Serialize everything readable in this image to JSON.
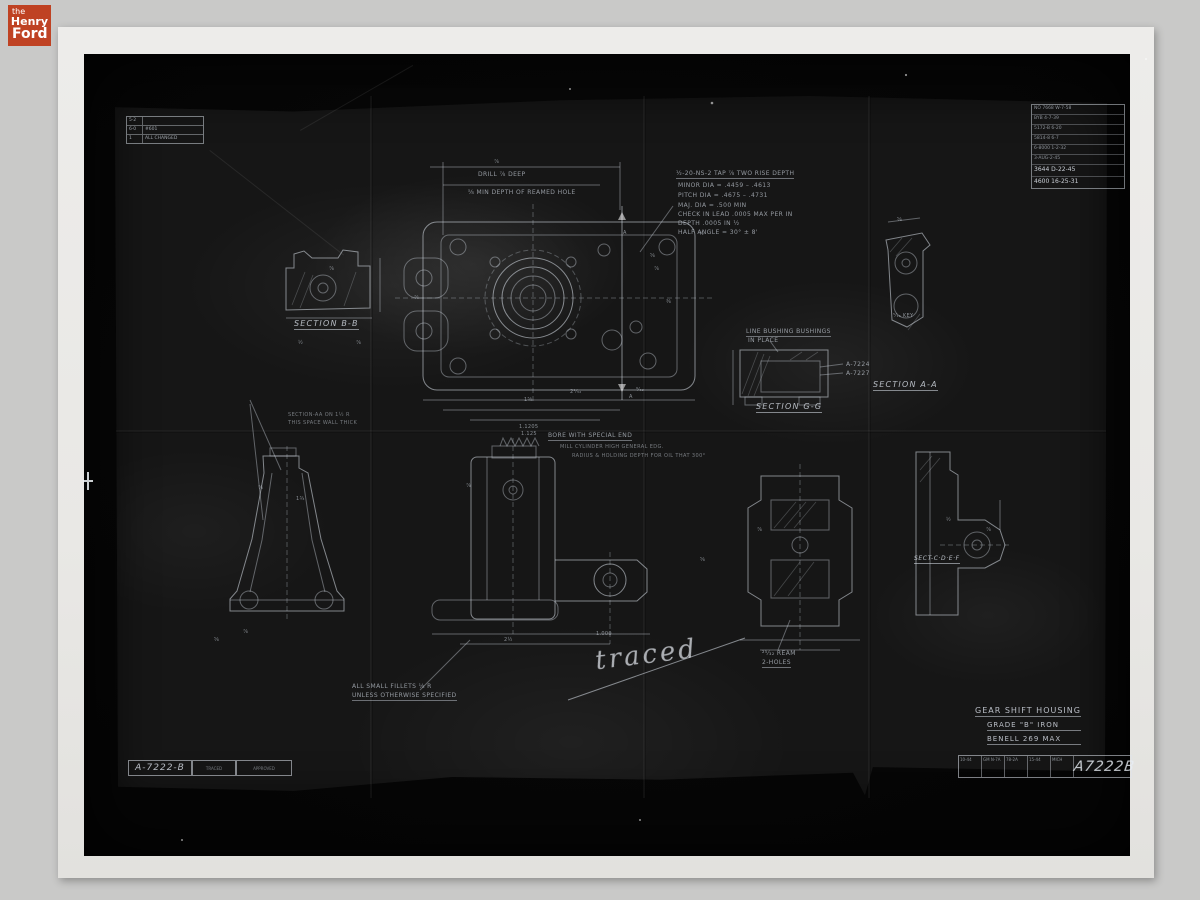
{
  "logo": {
    "the": "the",
    "henry": "Henry",
    "ford": "Ford"
  },
  "rev_table_tl": {
    "rows": [
      [
        "5·2",
        ""
      ],
      [
        "6·0",
        "#601"
      ],
      [
        "1",
        "ALL CHANGED"
      ]
    ]
  },
  "rev_table_tr": {
    "rows": [
      "NO 7668 W-7-58",
      "BYB 4-7-39",
      "5172-B 6-20",
      "5814-8 6-7",
      "6-8000 1-2-32",
      "3-AUG-2-45",
      "3644 D-22-45",
      "4600 16-25-31"
    ]
  },
  "notes": {
    "drill": "DRILL ⅞ DEEP",
    "ream": "⅝ MIN DEPTH OF REAMED HOLE",
    "thread1": "½-20-NS-2 TAP ⅞ TWO RISE DEPTH",
    "thread2": "MINOR DIA = .4459 – .4613",
    "thread3": "PITCH DIA = .4675 – .4731",
    "thread4": "MAJ. DIA = .500 MIN",
    "thread5": "CHECK IN LEAD .0005 MAX PER IN",
    "thread6": "DEPTH .0005 IN ½",
    "thread7": "HALF ANGLE = 30° ± 8'",
    "bushing1": "LINE BUSHING BUSHINGS",
    "bushing2": "IN PLACE",
    "a7224": "A-7224",
    "a7227": "A-7227",
    "bore": "BORE WITH SPECIAL END",
    "mill": "MILL CYLINDER HIGH GENERAL EDG.",
    "oil": "RADIUS & HOLDING DEPTH FOR OIL THAT 300°",
    "left1": "SECTION-AA ON 1½ R",
    "left2": "THIS SPACE WALL THICK",
    "fillets1": "ALL SMALL FILLETS ⅛ R",
    "fillets2": "UNLESS OTHERWISE SPECIFIED",
    "ream2a": "²⁵⁄₃₂ REAM",
    "ream2b": "2-HOLES",
    "traced": "traced"
  },
  "sections": {
    "bb": "SECTION B-B",
    "gg": "SECTION G-G",
    "aa": "SECTION A-A",
    "cdef": "SECT-C·D·E·F"
  },
  "title_block": {
    "title": "GEAR SHIFT HOUSING",
    "grade": "GRADE \"B\" IRON",
    "brinell": "BENELL 269 MAX",
    "number": "A7222B",
    "cells": [
      "10-44",
      "GM N-7A",
      "78-2A",
      "15-44",
      "MICH"
    ]
  },
  "corner_block_bl": {
    "number": "A-7222-B",
    "cells": [
      "TRACED",
      "APPROVED"
    ]
  },
  "dims": [
    {
      "t": "⅞",
      "x": 494,
      "y": 159
    },
    {
      "t": "⅝",
      "x": 650,
      "y": 253
    },
    {
      "t": "⅞",
      "x": 654,
      "y": 266
    },
    {
      "t": "⅜",
      "x": 666,
      "y": 299
    },
    {
      "t": "½",
      "x": 699,
      "y": 231
    },
    {
      "t": "A",
      "x": 623,
      "y": 230
    },
    {
      "t": "A",
      "x": 629,
      "y": 394
    },
    {
      "t": "⅞",
      "x": 414,
      "y": 295
    },
    {
      "t": "2¹⁄₃₂",
      "x": 570,
      "y": 389
    },
    {
      "t": "1⅝",
      "x": 524,
      "y": 397
    },
    {
      "t": "⁹⁄₃₂",
      "x": 636,
      "y": 387
    },
    {
      "t": "⅝",
      "x": 897,
      "y": 217
    },
    {
      "t": "⅞",
      "x": 329,
      "y": 266
    },
    {
      "t": "½",
      "x": 298,
      "y": 340
    },
    {
      "t": "⅞",
      "x": 356,
      "y": 340
    },
    {
      "t": "1.1205",
      "x": 519,
      "y": 424
    },
    {
      "t": "1.125",
      "x": 521,
      "y": 431
    },
    {
      "t": "⅞",
      "x": 258,
      "y": 485
    },
    {
      "t": "1¾",
      "x": 296,
      "y": 496
    },
    {
      "t": "⅞",
      "x": 466,
      "y": 483
    },
    {
      "t": "2½",
      "x": 504,
      "y": 637
    },
    {
      "t": "1.000",
      "x": 596,
      "y": 631
    },
    {
      "t": "⅝",
      "x": 700,
      "y": 557
    },
    {
      "t": "⅞",
      "x": 757,
      "y": 527
    },
    {
      "t": "½",
      "x": 946,
      "y": 517
    },
    {
      "t": "⅞",
      "x": 986,
      "y": 527
    },
    {
      "t": "⅝",
      "x": 214,
      "y": 637
    },
    {
      "t": "⅞",
      "x": 243,
      "y": 629
    },
    {
      "t": "⁵⁄₁₆ KEY",
      "x": 893,
      "y": 313
    }
  ]
}
